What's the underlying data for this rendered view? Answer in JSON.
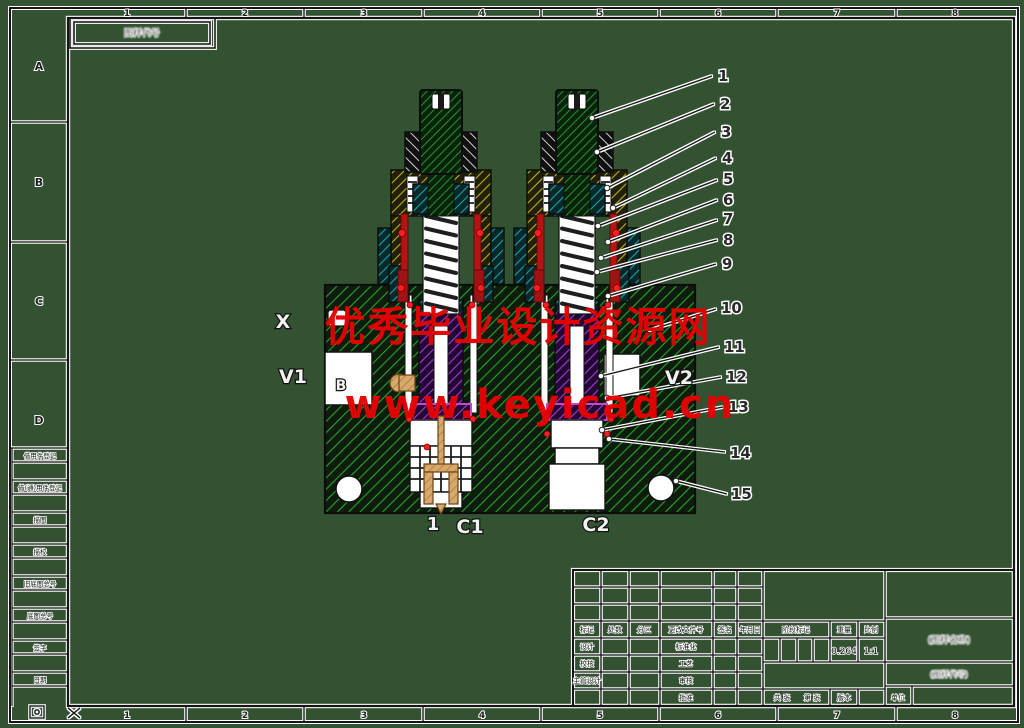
{
  "border": {
    "column_numbers": [
      "1",
      "2",
      "3",
      "4",
      "5",
      "6",
      "7",
      "8"
    ],
    "row_letters": [
      "A",
      "B",
      "C",
      "D"
    ],
    "corner_box_text": "图样代号"
  },
  "stamp_column": {
    "labels": [
      "借用件登记",
      "借(通)用件登记",
      "描图",
      "描校",
      "旧底图总号",
      "底图总号",
      "签字",
      "日期"
    ]
  },
  "title_block": {
    "change_header": [
      "标记",
      "处数",
      "分区",
      "更改文件号",
      "签名",
      "年月日"
    ],
    "roles_left": [
      "设计",
      "校核",
      "主管设计"
    ],
    "roles_mid": [
      "标准化",
      "工艺",
      "审核",
      "批准"
    ],
    "stage_label": "阶段标记",
    "weight_label": "重量",
    "scale_label": "比例",
    "weight_value": "0.264",
    "scale_value": "1:1",
    "sheets_label": "共 张",
    "sheet_no_label": "第 张",
    "version_label": "版本",
    "unit_label": "单位",
    "name_placeholder": "(图样名称)",
    "code_placeholder": "(图样代号)"
  },
  "ports": {
    "x": "X",
    "v1": "V1",
    "v2": "V2",
    "c1": "C1",
    "c2": "C2",
    "b": "B",
    "flow": "1"
  },
  "callouts": {
    "labels": [
      "1",
      "2",
      "3",
      "4",
      "5",
      "6",
      "7",
      "8",
      "9",
      "10",
      "11",
      "12",
      "13",
      "14",
      "15"
    ]
  },
  "watermark": {
    "line1": "优秀毕业设计资源网",
    "line2": "www.keyicad.cn",
    "color": "#e60000"
  },
  "colors": {
    "background": "#325232",
    "line": "#141414",
    "hatch_green": "#23a523",
    "hatch_stem_green": "#1f9426",
    "hatch_yellow": "#b9b312",
    "hatch_teal": "#15a3a3",
    "hatch_purple": "#a03ad6",
    "hatch_gray": "#cfcfcf",
    "seal_red": "#b51414",
    "marker_dot": "#ff1f1f",
    "tan": "#d8a96e",
    "magenta": "#cc44cc"
  }
}
